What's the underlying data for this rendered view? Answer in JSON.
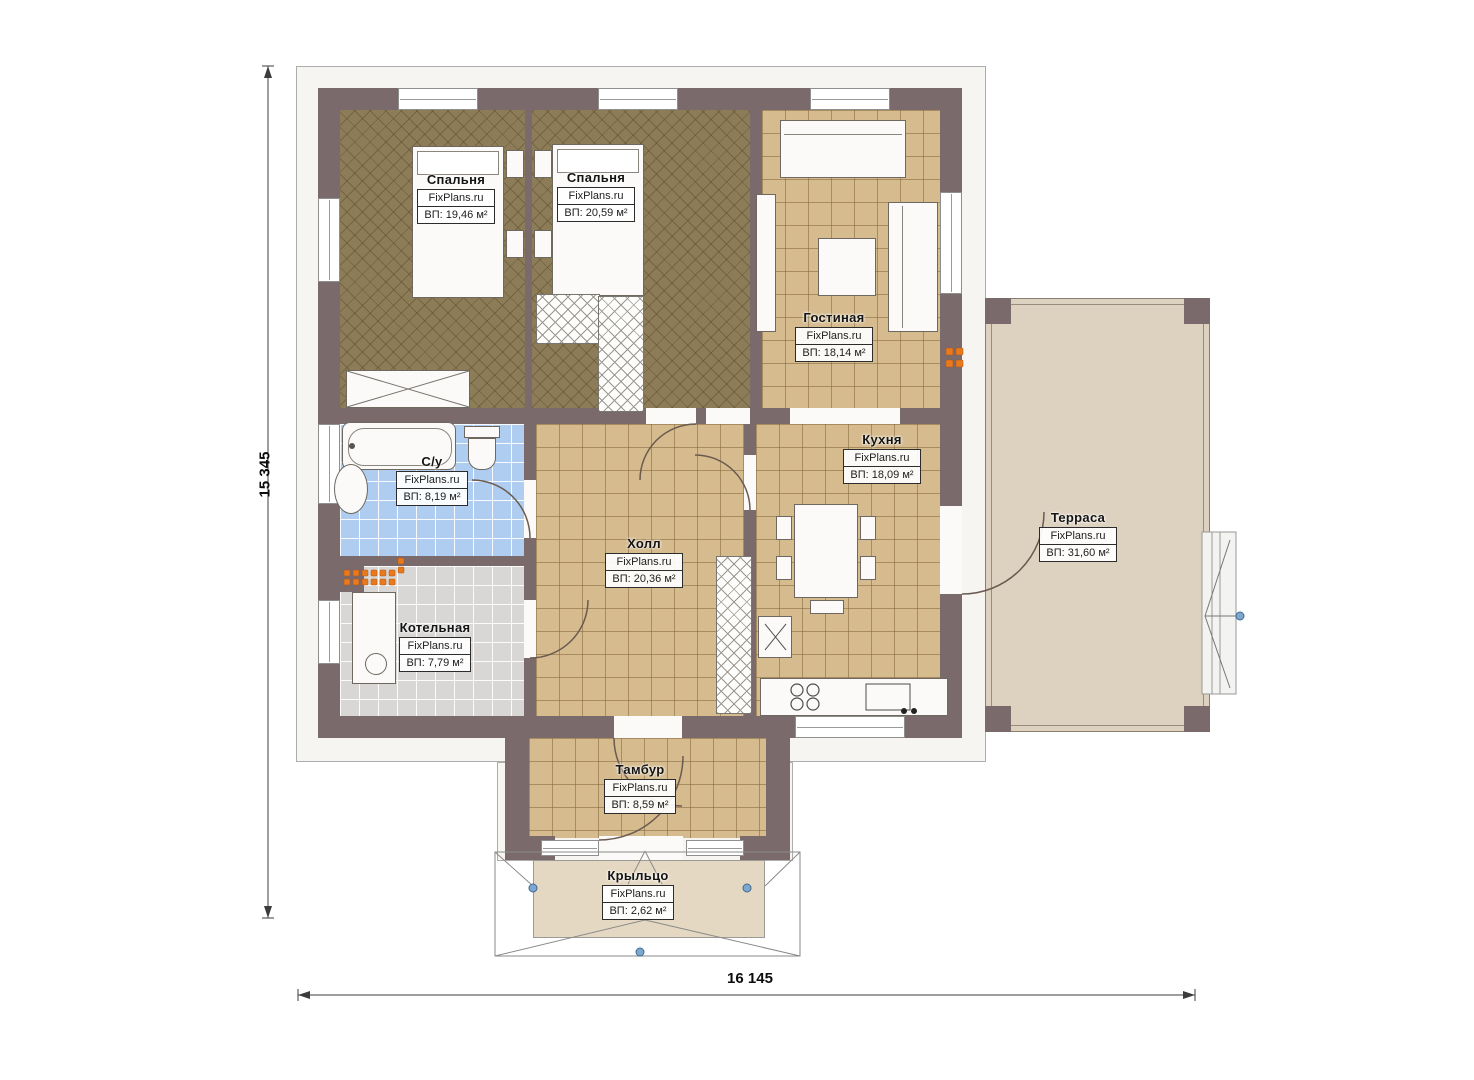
{
  "site_watermark": "FixPlans.ru",
  "dimensions": {
    "height_label": "15 345",
    "width_label": "16 145"
  },
  "rooms": [
    {
      "key": "bedroom-1",
      "name": "Спальня",
      "brand": "FixPlans.ru",
      "area": "ВП: 19,46 м²"
    },
    {
      "key": "bedroom-2",
      "name": "Спальня",
      "brand": "FixPlans.ru",
      "area": "ВП: 20,59 м²"
    },
    {
      "key": "living-room",
      "name": "Гостиная",
      "brand": "FixPlans.ru",
      "area": "ВП: 18,14 м²"
    },
    {
      "key": "bathroom",
      "name": "С/у",
      "brand": "FixPlans.ru",
      "area": "ВП: 8,19 м²"
    },
    {
      "key": "kitchen",
      "name": "Кухня",
      "brand": "FixPlans.ru",
      "area": "ВП: 18,09 м²"
    },
    {
      "key": "hall",
      "name": "Холл",
      "brand": "FixPlans.ru",
      "area": "ВП: 20,36 м²"
    },
    {
      "key": "boiler-room",
      "name": "Котельная",
      "brand": "FixPlans.ru",
      "area": "ВП: 7,79 м²"
    },
    {
      "key": "terrace",
      "name": "Терраса",
      "brand": "FixPlans.ru",
      "area": "ВП: 31,60 м²"
    },
    {
      "key": "vestibule",
      "name": "Тамбур",
      "brand": "FixPlans.ru",
      "area": "ВП: 8,59 м²"
    },
    {
      "key": "porch",
      "name": "Крыльцо",
      "brand": "FixPlans.ru",
      "area": "ВП: 2,62 м²"
    }
  ],
  "colors": {
    "wall": "#7b6a6c",
    "bedroom_floor": "#8c7c57",
    "tile_floor": "#d5bb8e",
    "bathroom_tile": "#aecdf1",
    "boiler_tile": "#d8d7d5",
    "terrace": "#ddd1bf",
    "radiator_orange": "#e8791e",
    "survey_point_blue": "#7fa7cc"
  }
}
